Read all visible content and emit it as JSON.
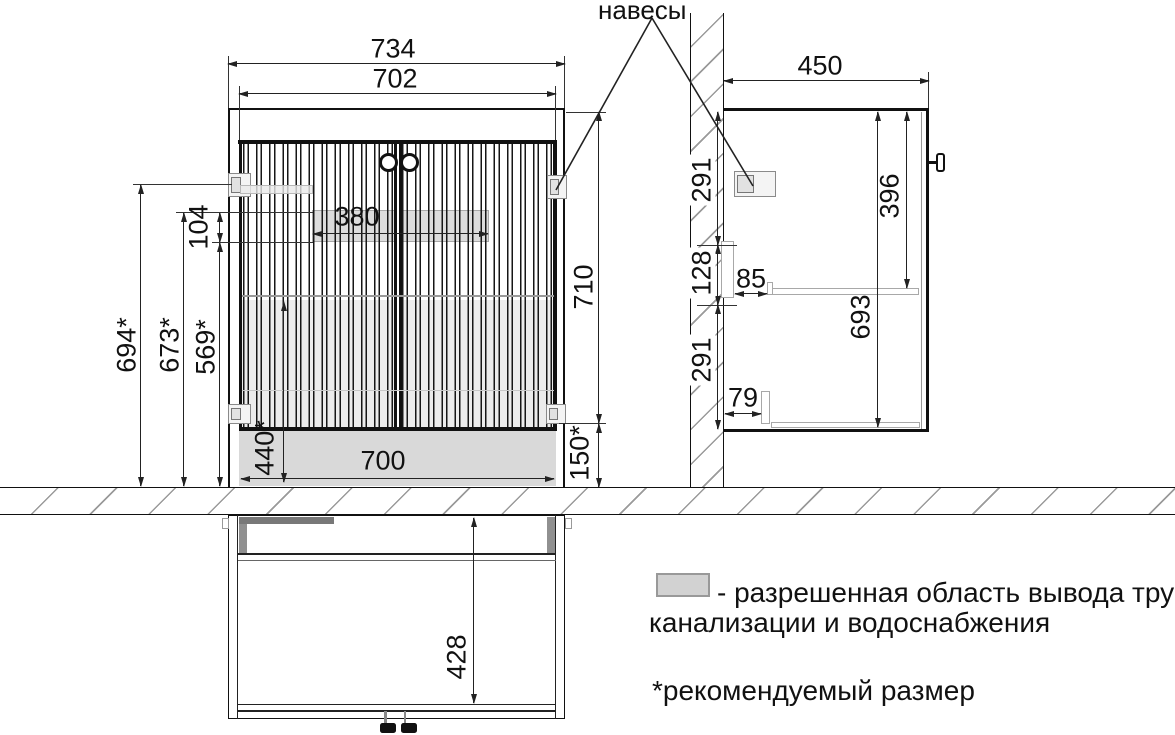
{
  "title_label": "навесы",
  "front_view": {
    "width_outer": "734",
    "width_inner": "702",
    "door_height": "710",
    "floor_gap": "150*",
    "height_hinge": "694*",
    "height_zone_top": "673*",
    "height_zone_bottom": "569*",
    "zone_height": "104",
    "zone_width": "380",
    "bottom_zone_height": "440*",
    "bottom_zone_width": "700"
  },
  "side_view": {
    "depth": "450",
    "wall_segment_top": "291",
    "wall_segment_mid": "128",
    "wall_segment_bottom": "291",
    "shelf_offset": "85",
    "bottom_offset": "79",
    "shelf_height": "396",
    "interior_height": "693"
  },
  "plan_view": {
    "interior_depth": "428"
  },
  "legend": {
    "swatch_line1": "- разрешенная область вывода труб",
    "swatch_line2": "канализации и водоснабжения",
    "footnote": "*рекомендуемый размер"
  },
  "colors": {
    "line": "#111111",
    "zone_fill": "#d9d9d9",
    "hatch": "#9a9a9a"
  }
}
